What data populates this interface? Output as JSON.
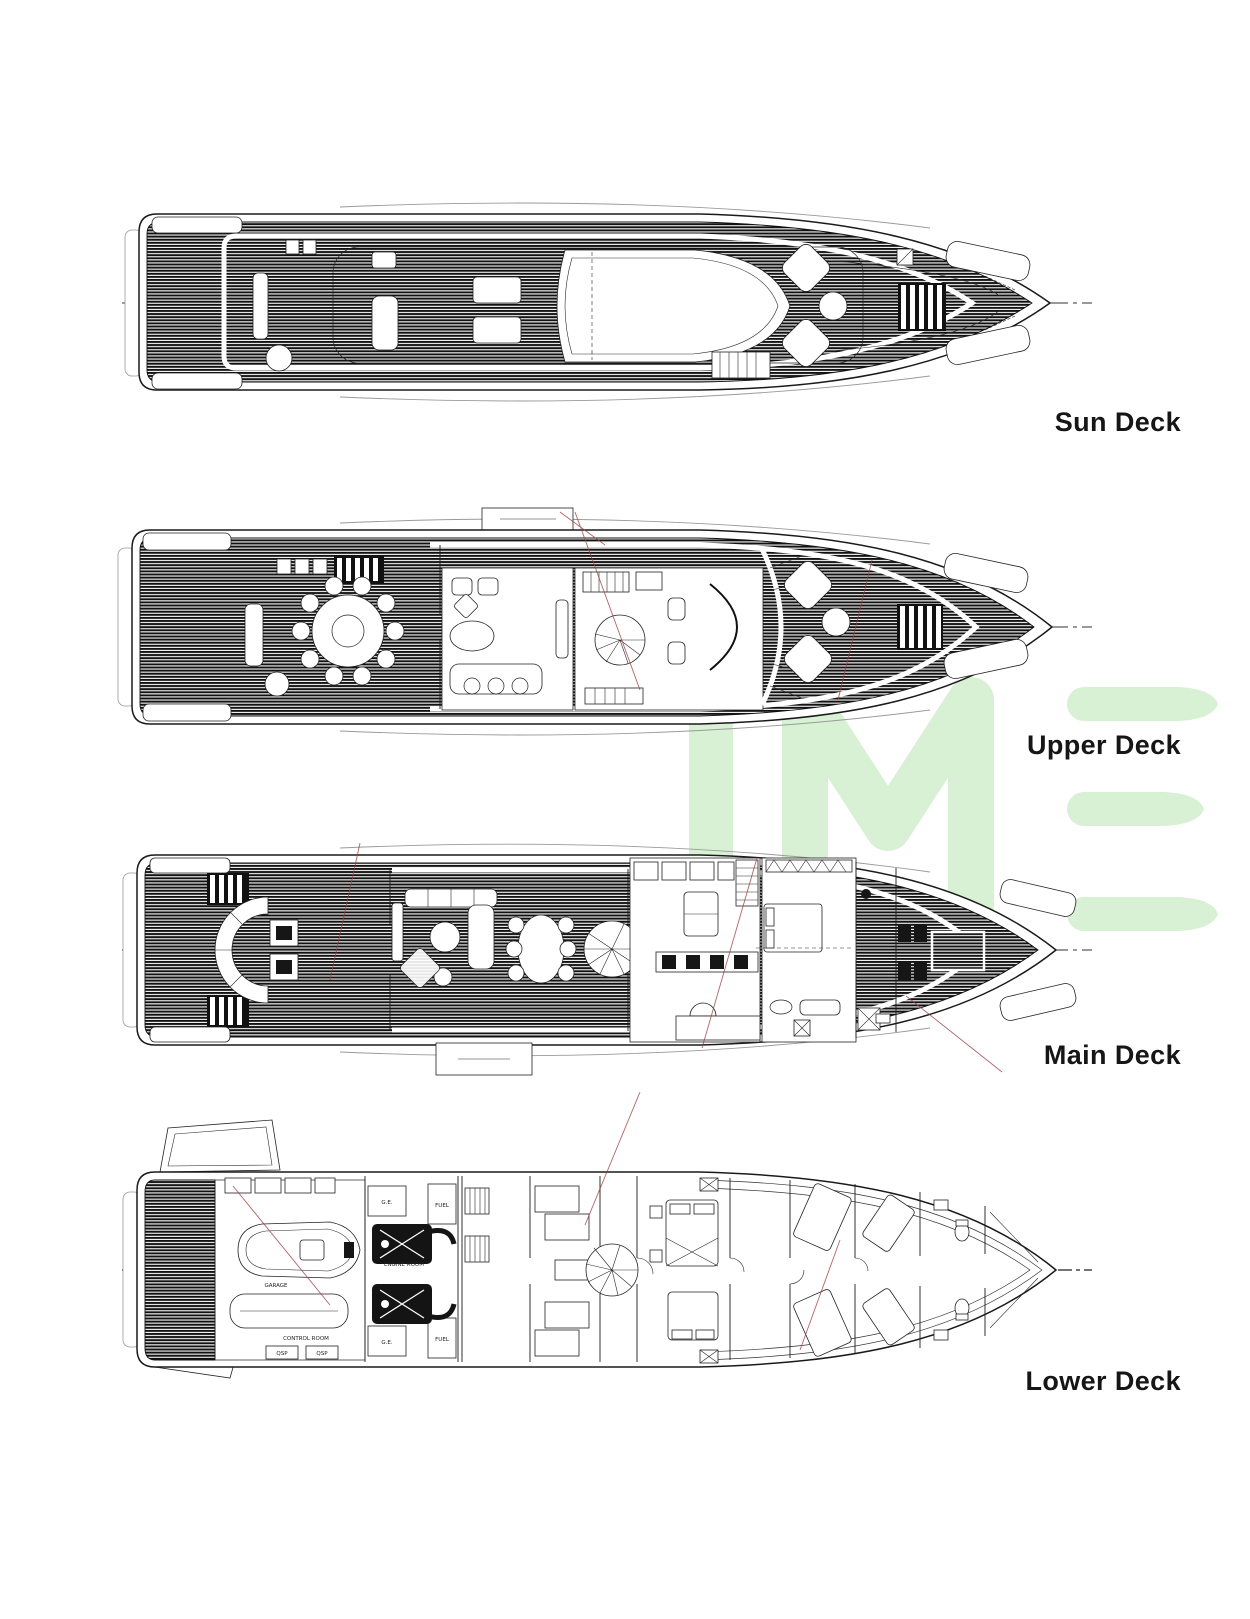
{
  "page": {
    "background": "#ffffff",
    "type": "yacht-deck-plan-sheet"
  },
  "watermark": {
    "text": "IME",
    "color": "#d8f0d3"
  },
  "decks": [
    {
      "id": "sun-deck",
      "label": "Sun Deck"
    },
    {
      "id": "upper-deck",
      "label": "Upper Deck"
    },
    {
      "id": "main-deck",
      "label": "Main Deck"
    },
    {
      "id": "lower-deck",
      "label": "Lower Deck"
    }
  ],
  "plan_annotations": {
    "garage": "GARAGE",
    "control_room": "CONTROL ROOM",
    "generator": "G.E.",
    "fuel": "FUEL",
    "qsp": "QSP",
    "engine_room": "ENGINE ROOM"
  },
  "drawing_colors": {
    "ink": "#1a1a1a",
    "leader_red": "#9b4040",
    "centerline": "#333333"
  }
}
